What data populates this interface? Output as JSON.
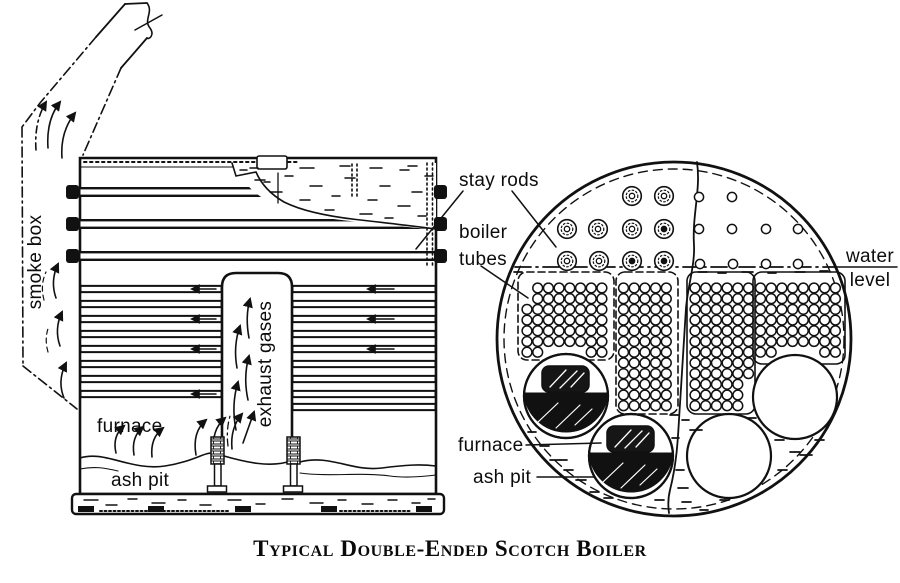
{
  "figure": {
    "caption": "Typical Double-Ended Scotch Boiler",
    "colors": {
      "ink": "#111111",
      "paper": "#ffffff"
    }
  },
  "side_view": {
    "labels": {
      "smoke_box": "smoke box",
      "exhaust_gases": "exhaust gases",
      "furnace": "furnace",
      "ash_pit": "ash pit"
    },
    "geometry": {
      "stay_band_ys": [
        192,
        224,
        256
      ],
      "tube_row_ys": [
        289,
        304,
        319,
        334,
        349,
        364,
        379,
        394
      ],
      "extra_right_rows": [
        407
      ],
      "tube_spans": [
        [
          81,
          221
        ],
        [
          293,
          435
        ]
      ],
      "left_arrow_rows": [
        0,
        2,
        4,
        7
      ],
      "right_arrow_rows": [
        0,
        2,
        4
      ],
      "cutaway_dashes": [
        [
          240,
          170,
          7
        ],
        [
          255,
          180,
          10
        ],
        [
          270,
          192,
          12
        ],
        [
          285,
          176,
          8
        ],
        [
          300,
          200,
          10
        ],
        [
          310,
          186,
          12
        ],
        [
          325,
          210,
          9
        ],
        [
          332,
          196,
          8
        ],
        [
          345,
          178,
          10
        ],
        [
          360,
          214,
          12
        ],
        [
          368,
          200,
          9
        ],
        [
          380,
          186,
          10
        ],
        [
          385,
          218,
          8
        ],
        [
          398,
          206,
          12
        ],
        [
          400,
          170,
          9
        ],
        [
          412,
          192,
          10
        ],
        [
          418,
          216,
          8
        ],
        [
          300,
          168,
          14
        ],
        [
          340,
          166,
          10
        ],
        [
          370,
          168,
          12
        ],
        [
          408,
          166,
          9
        ],
        [
          425,
          176,
          8
        ],
        [
          250,
          168,
          8
        ],
        [
          264,
          182,
          6
        ]
      ],
      "foundation_dashes": [
        [
          84,
          500,
          14
        ],
        [
          106,
          505,
          11
        ],
        [
          128,
          499,
          9
        ],
        [
          152,
          503,
          13
        ],
        [
          178,
          500,
          8
        ],
        [
          200,
          505,
          11
        ],
        [
          228,
          500,
          13
        ],
        [
          256,
          504,
          9
        ],
        [
          282,
          499,
          11
        ],
        [
          310,
          503,
          13
        ],
        [
          338,
          500,
          8
        ],
        [
          362,
          504,
          11
        ],
        [
          388,
          500,
          9
        ],
        [
          412,
          503,
          8
        ],
        [
          428,
          499,
          7
        ]
      ]
    }
  },
  "end_view": {
    "labels": {
      "stay_rods": "stay rods",
      "boiler_tubes": [
        "boiler",
        "tubes"
      ],
      "water_level": [
        "water",
        "level"
      ],
      "furnace": "furnace",
      "ash_pit": "ash pit"
    },
    "geometry": {
      "center": [
        674,
        339
      ],
      "radius": 177,
      "inner_dash_radius": 170,
      "water_line_y": 267,
      "stay_rods": [
        [
          632,
          196
        ],
        [
          664,
          196
        ],
        [
          567,
          229
        ],
        [
          598,
          229
        ],
        [
          632,
          229
        ],
        [
          664,
          229
        ],
        [
          567,
          261
        ],
        [
          599,
          261
        ],
        [
          632,
          261
        ],
        [
          664,
          261
        ]
      ],
      "dark_centers": [
        5,
        8,
        9
      ],
      "plain_stays": [
        [
          699,
          197
        ],
        [
          732,
          197
        ],
        [
          699,
          229
        ],
        [
          732,
          229
        ],
        [
          766,
          229
        ],
        [
          798,
          229
        ],
        [
          700,
          264
        ],
        [
          733,
          264
        ],
        [
          766,
          264
        ],
        [
          798,
          264
        ]
      ],
      "banks": [
        {
          "x": 518,
          "y": 272,
          "w": 96,
          "h": 88,
          "rx": 9,
          "border": "dashed",
          "cx0": 527,
          "cy0": 288,
          "cols": 8,
          "rows": 7,
          "pitch": 10.7,
          "skip": [
            [
              0,
              0
            ],
            [
              0,
              1
            ]
          ]
        },
        {
          "x": 616,
          "y": 272,
          "w": 62,
          "h": 142,
          "rx": 9,
          "border": "dashed",
          "cx0": 623.5,
          "cy0": 288,
          "cols": 5,
          "rows": 12,
          "pitch": 10.7,
          "skip": []
        },
        {
          "x": 687,
          "y": 272,
          "w": 68,
          "h": 142,
          "rx": 9,
          "border": "solid",
          "cx0": 695,
          "cy0": 288,
          "cols": 6,
          "rows": 12,
          "pitch": 10.7,
          "skip": []
        },
        {
          "x": 753,
          "y": 272,
          "w": 92,
          "h": 92,
          "rx": 9,
          "border": "solid",
          "cx0": 760.5,
          "cy0": 288,
          "cols": 8,
          "rows": 7,
          "pitch": 10.7,
          "skip": []
        }
      ],
      "furnaces": [
        {
          "cx": 566,
          "cy": 396,
          "r": 42,
          "fired": true
        },
        {
          "cx": 631,
          "cy": 456,
          "r": 42,
          "fired": true
        },
        {
          "cx": 729,
          "cy": 456,
          "r": 42,
          "fired": false
        },
        {
          "cx": 795,
          "cy": 397,
          "r": 42,
          "fired": false
        }
      ],
      "water_dashes": [
        [
          528,
          432,
          8
        ],
        [
          540,
          446,
          9
        ],
        [
          550,
          460,
          10
        ],
        [
          564,
          470,
          9
        ],
        [
          576,
          480,
          10
        ],
        [
          590,
          492,
          9
        ],
        [
          604,
          498,
          9
        ],
        [
          560,
          460,
          7
        ],
        [
          672,
          438,
          7
        ],
        [
          682,
          420,
          7
        ],
        [
          676,
          470,
          8
        ],
        [
          678,
          488,
          10
        ],
        [
          682,
          502,
          9
        ],
        [
          690,
          430,
          12
        ],
        [
          700,
          510,
          8
        ],
        [
          720,
          500,
          9
        ],
        [
          748,
          418,
          8
        ],
        [
          775,
          440,
          9
        ],
        [
          790,
          452,
          10
        ],
        [
          800,
          455,
          12
        ],
        [
          778,
          470,
          9
        ],
        [
          815,
          440,
          9
        ],
        [
          670,
          415,
          8
        ],
        [
          655,
          500,
          9
        ],
        [
          698,
          272,
          9
        ],
        [
          718,
          273,
          8
        ],
        [
          742,
          272,
          11
        ],
        [
          768,
          273,
          8
        ],
        [
          795,
          272,
          10
        ],
        [
          820,
          271,
          8
        ],
        [
          514,
          272,
          8
        ]
      ]
    }
  }
}
